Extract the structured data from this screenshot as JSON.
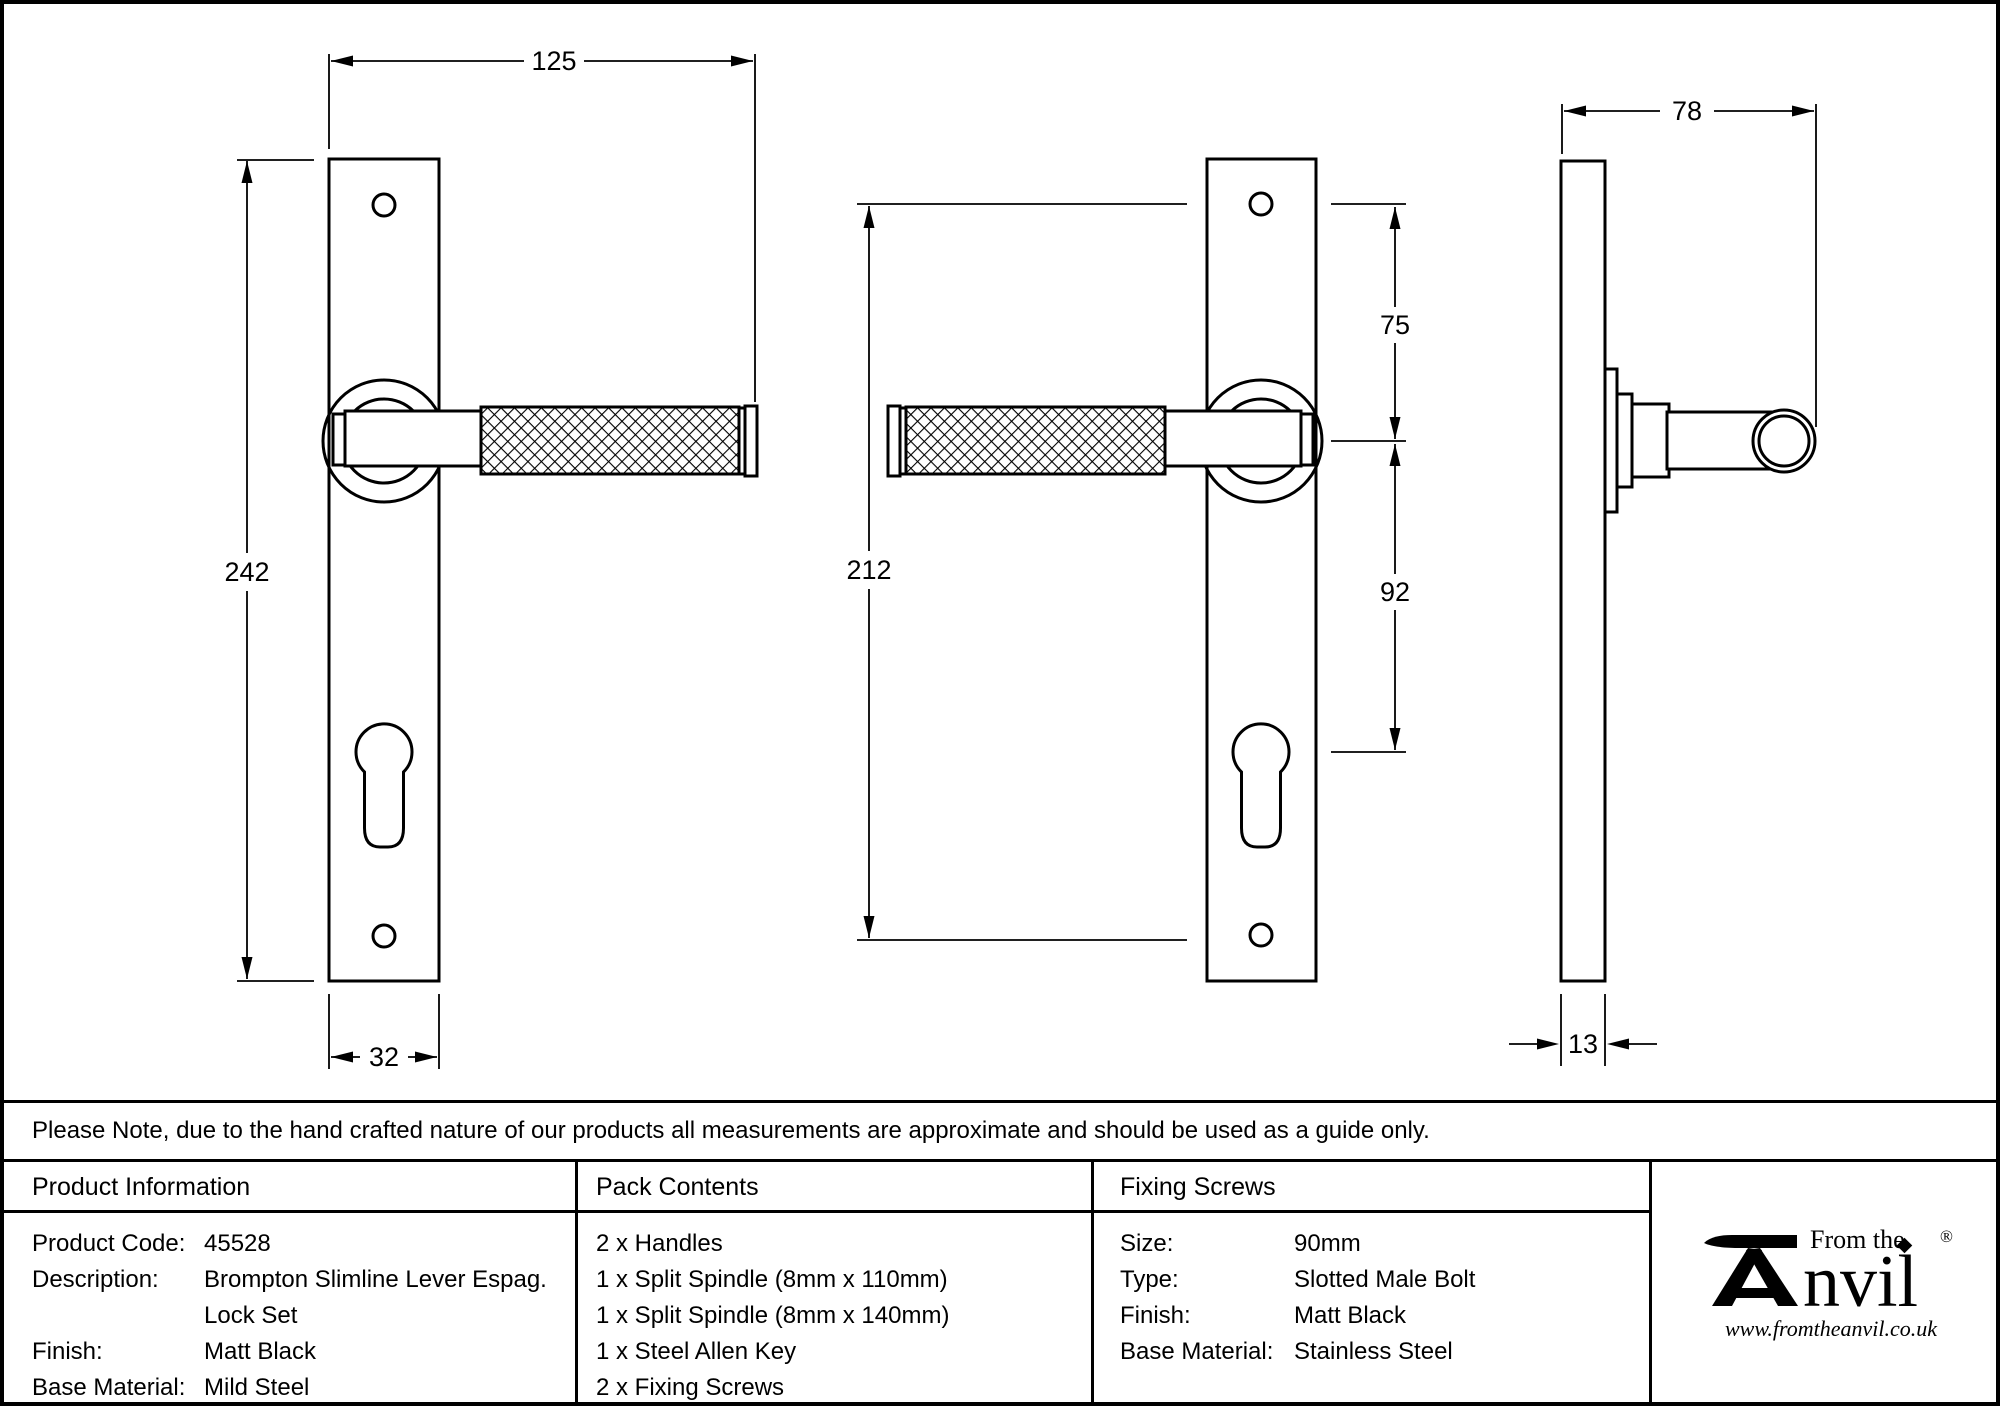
{
  "dims": {
    "front_width": "125",
    "front_height": "242",
    "plate_width": "32",
    "mid_height": "212",
    "top_to_handle": "75",
    "handle_to_cylinder": "92",
    "side_depth": "78",
    "plate_thickness": "13"
  },
  "note": "Please Note, due to the hand crafted nature of our products all measurements are approximate and should be used as a guide only.",
  "product_information": {
    "header": "Product Information",
    "rows": [
      {
        "label": "Product Code:",
        "value": "45528"
      },
      {
        "label": "Description:",
        "value": "Brompton Slimline Lever Espag. Lock Set"
      },
      {
        "label": "Finish:",
        "value": "Matt Black"
      },
      {
        "label": "Base Material:",
        "value": "Mild Steel"
      }
    ]
  },
  "pack_contents": {
    "header": "Pack Contents",
    "items": [
      "2 x Handles",
      "1 x Split Spindle (8mm x 110mm)",
      "1 x Split Spindle (8mm x 140mm)",
      "1 x Steel Allen Key",
      "2 x Fixing Screws"
    ]
  },
  "fixing_screws": {
    "header": "Fixing Screws",
    "rows": [
      {
        "label": "Size:",
        "value": "90mm"
      },
      {
        "label": "Type:",
        "value": "Slotted Male Bolt"
      },
      {
        "label": "Finish:",
        "value": "Matt Black"
      },
      {
        "label": "Base Material:",
        "value": "Stainless Steel"
      }
    ]
  },
  "brand": {
    "prefix": "From the",
    "name_rest": "nvil",
    "registered": "®",
    "website": "www.fromtheanvil.co.uk"
  },
  "colors": {
    "ink": "#000000",
    "paper": "#ffffff"
  }
}
